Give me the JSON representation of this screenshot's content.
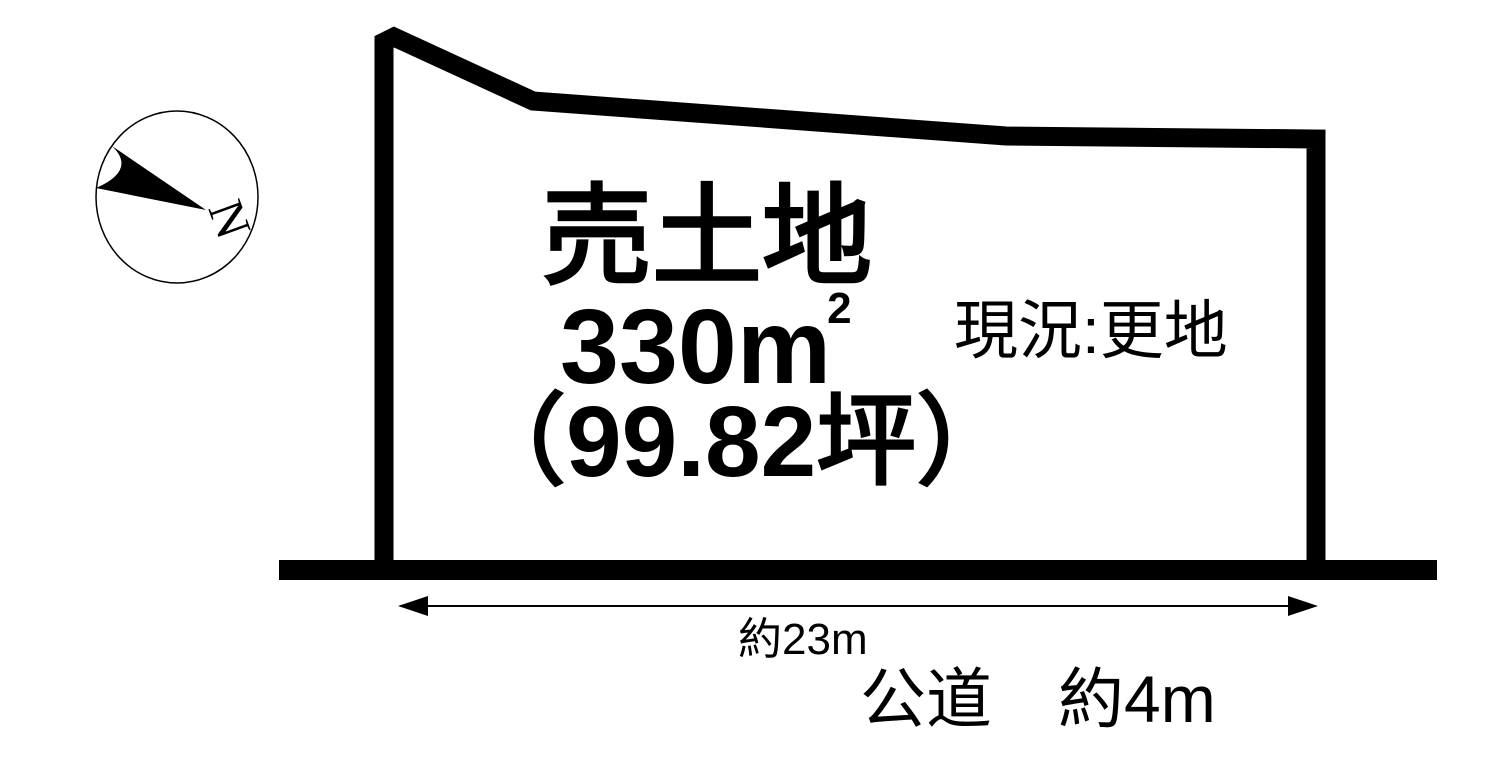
{
  "compass": {
    "north_label": "N"
  },
  "parcel": {
    "title": "売土地",
    "area_m2_value": "330m",
    "area_m2_sup": "2",
    "area_tsubo": "（99.82坪）",
    "status": "現況:更地"
  },
  "road": {
    "frontage_dimension": "約23m",
    "road_label": "公道　約4m"
  },
  "colors": {
    "ink": "#000000",
    "background": "#ffffff"
  }
}
